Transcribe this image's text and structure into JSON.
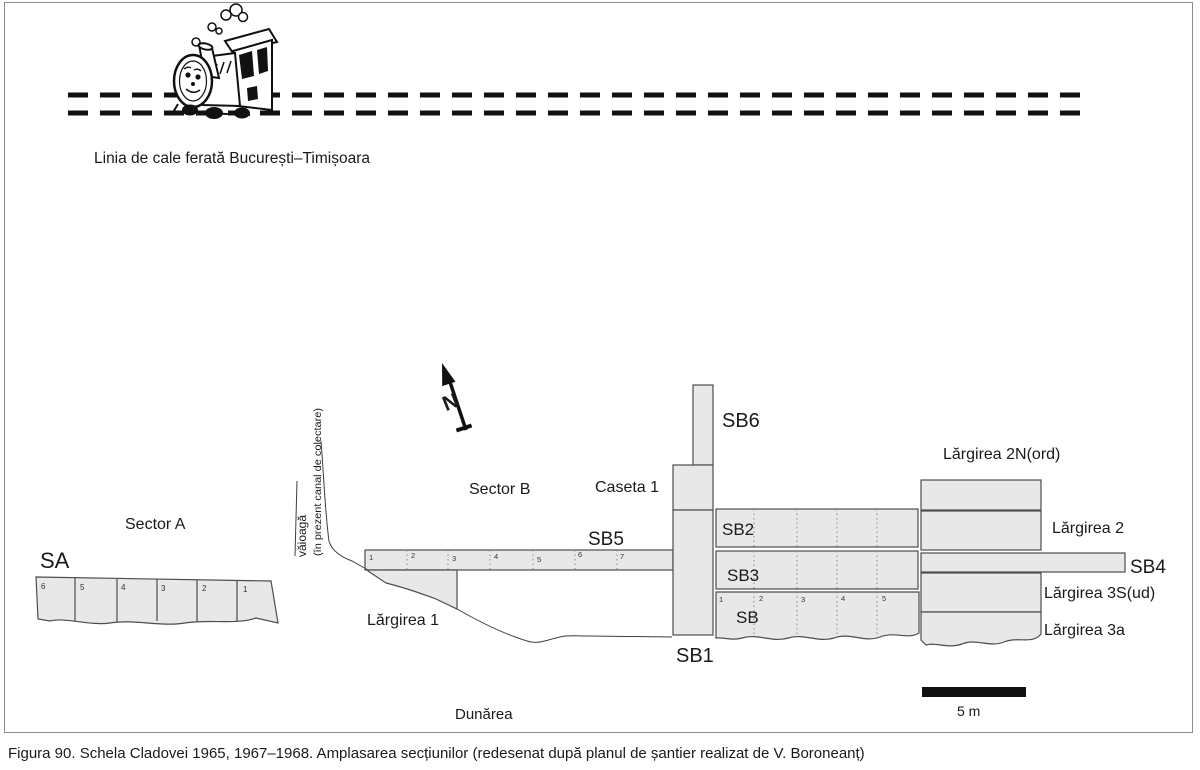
{
  "figure": {
    "caption": "Figura 90. Schela Cladovei 1965, 1967–1968. Amplasarea secțiunilor (redesenat după planul de șantier realizat de V. Boroneanț)"
  },
  "labels": {
    "railway": "Linia de cale ferată București–Timișoara",
    "sector_a": "Sector A",
    "sector_b": "Sector B",
    "sa": "SA",
    "sb6": "SB6",
    "sb5": "SB5",
    "sb4": "SB4",
    "sb3": "SB3",
    "sb2": "SB2",
    "sb1": "SB1",
    "sb": "SB",
    "caseta1": "Caseta 1",
    "largirea1": "Lărgirea 1",
    "largirea2n": "Lărgirea 2N(ord)",
    "largirea2": "Lărgirea 2",
    "largirea3s": "Lărgirea 3S(ud)",
    "largirea3a": "Lărgirea 3a",
    "valley_line1": "văioagă",
    "valley_line2": "(în prezent canal de colectare)",
    "river": "Dunărea",
    "scale": "5 m",
    "north": "N"
  },
  "cells": {
    "sa": [
      "6",
      "5",
      "4",
      "3",
      "2",
      "1"
    ],
    "sb5": [
      "1",
      "2",
      "3",
      "4",
      "5",
      "6",
      "7"
    ],
    "sb": [
      "1",
      "2",
      "3",
      "4",
      "5"
    ]
  },
  "colors": {
    "section_fill": "#e8e8e8",
    "section_stroke": "#4d4d4d",
    "divider_stroke": "#8a8a8a",
    "ink": "#111111",
    "frame": "#8c8c8c"
  }
}
